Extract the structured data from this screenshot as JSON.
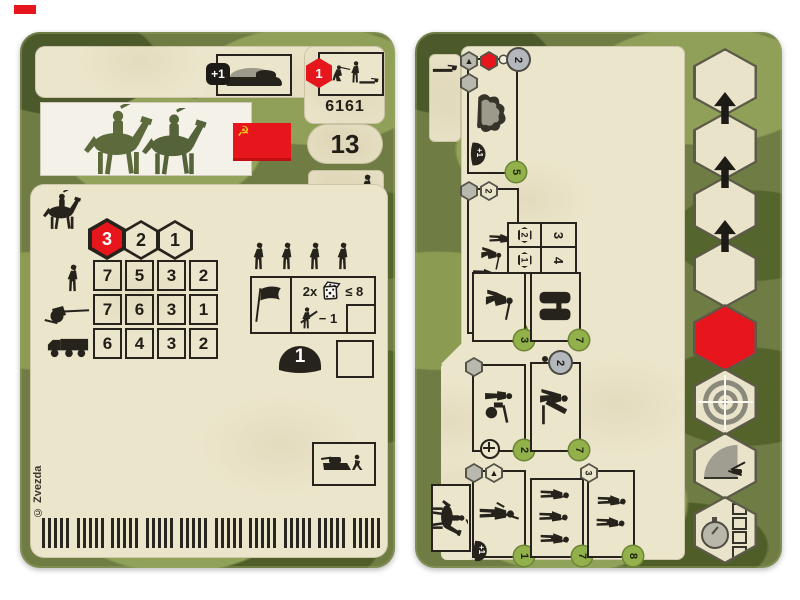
{
  "colors": {
    "camo_base": "#6f7d44",
    "camo_dark": "#4c592b",
    "camo_light": "#91a058",
    "panel_beige": "#ebe5cb",
    "ink_black": "#211e18",
    "accent_red": "#e7161d",
    "badge_green": "#92b14b",
    "flag_yellow": "#f4ce1b"
  },
  "icons": {
    "cavalry": "horse-with-rider-silhouette",
    "infantry": "soldier-silhouette",
    "field_gun": "artillery-gun-silhouette",
    "truck": "truck-silhouette",
    "dice": "die-icon",
    "flag": "black-flag-icon",
    "helmet": "helmet-icon",
    "tank_runner": "tank-and-running-soldier-icon",
    "binoculars": "binoculars-icon",
    "bush": "camouflage-bush-icon",
    "target": "crosshair-target-icon",
    "artillery_arc": "artillery-fan-icon",
    "stopwatch": "turn-timer-icon",
    "move_arrow": "up-arrow-icon",
    "ammo": "rifle-cartridge-strip"
  },
  "left_card": {
    "header": {
      "upgrade_value": "+1",
      "order_value": "1",
      "set_number": "6161"
    },
    "flag_symbol": "☭",
    "points_value": "13",
    "movement_hexes": {
      "h1": "3",
      "h2": "2",
      "h3": "1"
    },
    "combat_table": {
      "rows": [
        {
          "icon": "infantry-icon",
          "values": [
            "7",
            "5",
            "3",
            "2"
          ]
        },
        {
          "icon": "field-gun-icon",
          "values": [
            "7",
            "6",
            "3",
            "1"
          ]
        },
        {
          "icon": "truck-icon",
          "values": [
            "6",
            "4",
            "3",
            "2"
          ]
        }
      ]
    },
    "attack_box": {
      "multiplier": "2x",
      "threshold": "≤ 8",
      "penalty": "− 1"
    },
    "helmet_value": "1",
    "copyright": "© Zvezda"
  },
  "right_card": {
    "roster": {
      "terrain": {
        "crew": "2",
        "strength": "5",
        "helmet_bonus": "+1"
      },
      "cavalry": {
        "hex": "2",
        "strength": "5"
      },
      "range_table": {
        "hex_a": "2",
        "val_a": "3",
        "hex_b": "1",
        "val_b": "4"
      },
      "sniper": {
        "strength": "3"
      },
      "binoculars": {
        "strength": "7"
      },
      "machine_gun": {
        "strength": "2"
      },
      "mortar": {
        "crew": "2",
        "strength": "7"
      },
      "officer": {
        "strength": "1",
        "helmet_bonus": "+1"
      },
      "riflemen": {
        "strength": "7"
      },
      "squad": {
        "hex": "3",
        "strength": "8"
      }
    }
  }
}
